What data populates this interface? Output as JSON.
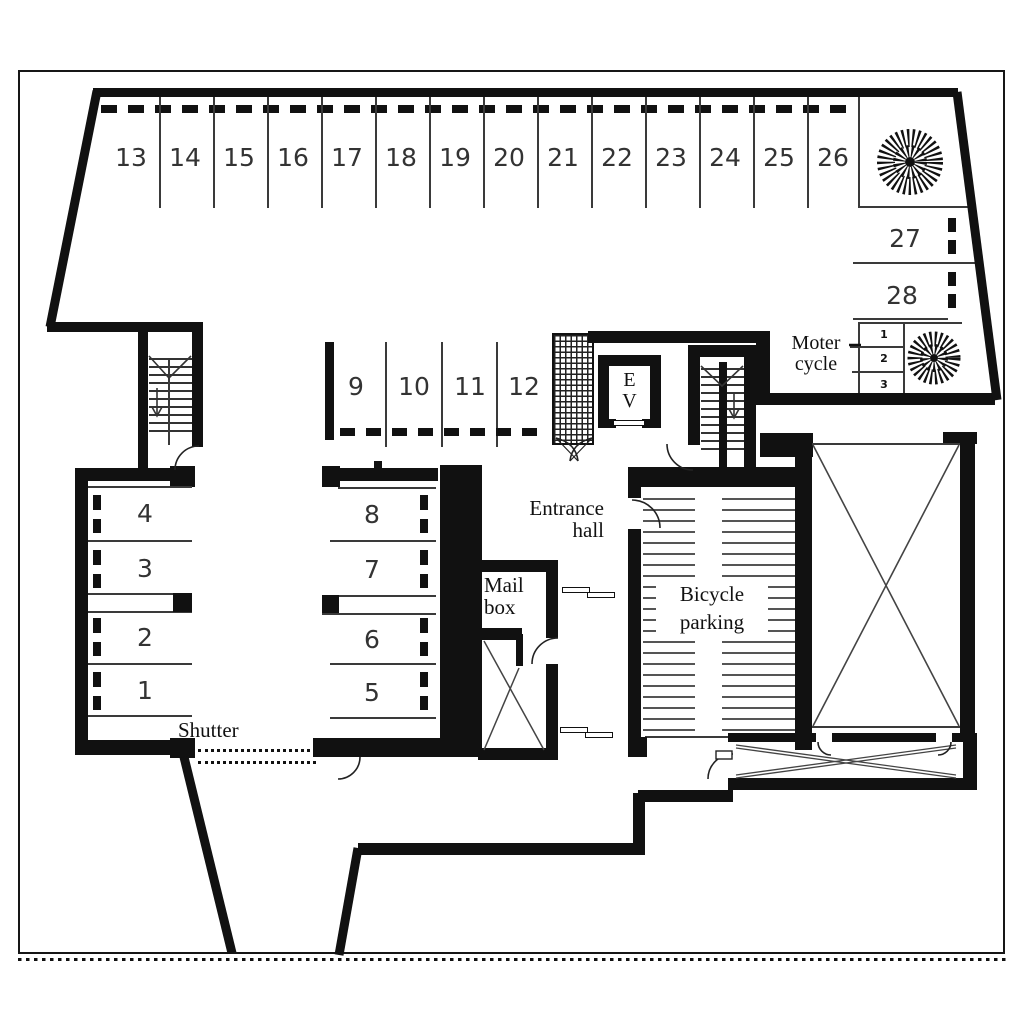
{
  "drawing": {
    "type": "floor-plan",
    "bg_color": "#ffffff",
    "wall_color": "#111111",
    "line_color": "#3a3a3a"
  },
  "parking": {
    "top_row": [
      "13",
      "14",
      "15",
      "16",
      "17",
      "18",
      "19",
      "20",
      "21",
      "22",
      "23",
      "24",
      "25",
      "26"
    ],
    "right_column": [
      "27",
      "28"
    ],
    "middle_row": [
      "9",
      "10",
      "11",
      "12"
    ],
    "left_column": [
      "4",
      "3",
      "2",
      "1"
    ],
    "center_column": [
      "8",
      "7",
      "6",
      "5"
    ],
    "motorcycle_bays": [
      "1",
      "2",
      "3"
    ]
  },
  "labels": {
    "entrance_hall": [
      "Entrance",
      "hall"
    ],
    "mail_box": [
      "Mail",
      "box"
    ],
    "bicycle_parking": [
      "Bicycle",
      "parking"
    ],
    "motorcycle": [
      "Moter",
      "cycle"
    ],
    "shutter": "Shutter",
    "elevator": [
      "E",
      "V"
    ]
  }
}
